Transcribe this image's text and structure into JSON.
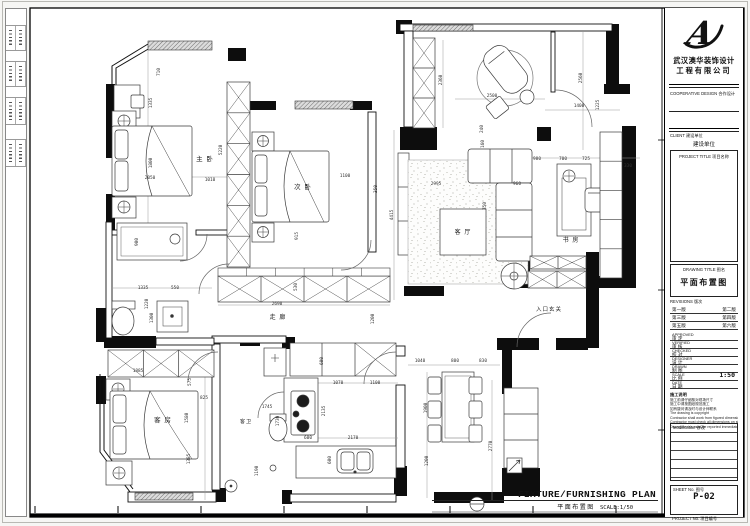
{
  "titleblock": {
    "logo_letter": "A",
    "company_line1": "武汉澳华装饰设计",
    "company_line2": "工程有限公司",
    "cooperative_label": "COOPERATIVE DESIGN   合作设计",
    "client_label": "CLIENT   建设单位",
    "client_value": "建设单位",
    "project_title_label": "PROJECT TITLE   项目名称",
    "drawing_title_label": "DRAWING TITLE   图名",
    "drawing_title_value": "平面布置图",
    "revisions_label": "REVISIONS   版次",
    "revision_rows": [
      [
        "第一版",
        "第二版"
      ],
      [
        "第三版",
        "第四版"
      ],
      [
        "第五版",
        "第六版"
      ]
    ],
    "sign_rows": [
      {
        "en": "APPROVED",
        "zh": "审 定",
        "value": ""
      },
      {
        "en": "VERIFIED",
        "zh": "审 核",
        "value": ""
      },
      {
        "en": "CHECKED",
        "zh": "校 对",
        "value": ""
      },
      {
        "en": "DESIGNER",
        "zh": "设 计",
        "value": ""
      },
      {
        "en": "DRAWN",
        "zh": "制 图",
        "value": ""
      },
      {
        "en": "SCALE",
        "zh": "比 例",
        "value": "1:50"
      },
      {
        "en": "DATE",
        "zh": "日 期",
        "value": ""
      }
    ],
    "notes_title": "施工说明",
    "notes": [
      "施工前请仔细核对现场尺寸",
      "施工中请按图纸规范施工",
      "如有疑问请及时与设计师联系",
      "The drawing is copyright",
      "Contractor shall work from figured dimensions only",
      "Contractor must check all dimensions on site",
      "Discrepancies must be reported immediately to architect"
    ],
    "modification_label": "Modification   修改",
    "sheet_no_label": "SHEET No.   图号",
    "sheet_no_value": "P-02",
    "project_no_label": "PROJECT No.   项目编号"
  },
  "footer": {
    "title_en": "FIXTURE/FURNISHING PLAN",
    "title_zh": "平面布置图",
    "scale": "SCALE:1/50"
  },
  "plan": {
    "rooms": [
      {
        "label": "主 卧",
        "x": 205,
        "y": 161,
        "s": 6.5
      },
      {
        "label": "次 卧",
        "x": 303,
        "y": 189,
        "s": 6.5
      },
      {
        "label": "客 厅",
        "x": 463,
        "y": 234,
        "s": 6
      },
      {
        "label": "书 房",
        "x": 571,
        "y": 242,
        "s": 6
      },
      {
        "label": "走 廊",
        "x": 278,
        "y": 319,
        "s": 6
      },
      {
        "label": "入口玄关",
        "x": 549,
        "y": 311,
        "s": 5.5
      },
      {
        "label": "客 房",
        "x": 163,
        "y": 422,
        "s": 6.5
      },
      {
        "label": "客卫",
        "x": 246,
        "y": 423,
        "s": 5
      }
    ],
    "dims": [
      {
        "t": "710",
        "x": 160,
        "y": 72,
        "v": 1
      },
      {
        "t": "1335",
        "x": 152,
        "y": 103,
        "v": 1
      },
      {
        "t": "1800",
        "x": 152,
        "y": 163,
        "v": 1
      },
      {
        "t": "2050",
        "x": 150,
        "y": 179,
        "v": 0
      },
      {
        "t": "1010",
        "x": 210,
        "y": 181,
        "v": 0
      },
      {
        "t": "5220",
        "x": 222,
        "y": 150,
        "v": 1
      },
      {
        "t": "915",
        "x": 298,
        "y": 236,
        "v": 1
      },
      {
        "t": "1100",
        "x": 345,
        "y": 177,
        "v": 0
      },
      {
        "t": "350",
        "x": 377,
        "y": 189,
        "v": 1
      },
      {
        "t": "4415",
        "x": 393,
        "y": 215,
        "v": 1
      },
      {
        "t": "2360",
        "x": 442,
        "y": 80,
        "v": 1
      },
      {
        "t": "2500",
        "x": 492,
        "y": 97,
        "v": 0
      },
      {
        "t": "2560",
        "x": 582,
        "y": 78,
        "v": 1
      },
      {
        "t": "1400",
        "x": 579,
        "y": 107,
        "v": 0
      },
      {
        "t": "1225",
        "x": 599,
        "y": 105,
        "v": 1
      },
      {
        "t": "240",
        "x": 483,
        "y": 129,
        "v": 1
      },
      {
        "t": "980",
        "x": 537,
        "y": 160,
        "v": 0
      },
      {
        "t": "700",
        "x": 563,
        "y": 160,
        "v": 0
      },
      {
        "t": "725",
        "x": 586,
        "y": 160,
        "v": 0
      },
      {
        "t": "330",
        "x": 628,
        "y": 167,
        "v": 0
      },
      {
        "t": "2995",
        "x": 436,
        "y": 185,
        "v": 0
      },
      {
        "t": "160",
        "x": 484,
        "y": 144,
        "v": 1
      },
      {
        "t": "350",
        "x": 486,
        "y": 206,
        "v": 1
      },
      {
        "t": "960",
        "x": 517,
        "y": 185,
        "v": 0
      },
      {
        "t": "2690",
        "x": 277,
        "y": 305,
        "v": 0
      },
      {
        "t": "530",
        "x": 297,
        "y": 287,
        "v": 1
      },
      {
        "t": "1200",
        "x": 374,
        "y": 319,
        "v": 1
      },
      {
        "t": "1885",
        "x": 138,
        "y": 372,
        "v": 0
      },
      {
        "t": "575",
        "x": 191,
        "y": 382,
        "v": 1
      },
      {
        "t": "825",
        "x": 204,
        "y": 399,
        "v": 0
      },
      {
        "t": "1580",
        "x": 188,
        "y": 418,
        "v": 1
      },
      {
        "t": "1385",
        "x": 190,
        "y": 459,
        "v": 1
      },
      {
        "t": "1190",
        "x": 258,
        "y": 471,
        "v": 1
      },
      {
        "t": "1745",
        "x": 267,
        "y": 408,
        "v": 0
      },
      {
        "t": "1730",
        "x": 279,
        "y": 421,
        "v": 1
      },
      {
        "t": "600",
        "x": 323,
        "y": 361,
        "v": 1
      },
      {
        "t": "1070",
        "x": 338,
        "y": 384,
        "v": 0
      },
      {
        "t": "1100",
        "x": 375,
        "y": 384,
        "v": 0
      },
      {
        "t": "2135",
        "x": 325,
        "y": 411,
        "v": 1
      },
      {
        "t": "600",
        "x": 308,
        "y": 439,
        "v": 0
      },
      {
        "t": "2170",
        "x": 353,
        "y": 439,
        "v": 0
      },
      {
        "t": "600",
        "x": 331,
        "y": 460,
        "v": 1
      },
      {
        "t": "1040",
        "x": 420,
        "y": 362,
        "v": 0
      },
      {
        "t": "800",
        "x": 455,
        "y": 362,
        "v": 0
      },
      {
        "t": "830",
        "x": 483,
        "y": 362,
        "v": 0
      },
      {
        "t": "1900",
        "x": 427,
        "y": 408,
        "v": 1
      },
      {
        "t": "1200",
        "x": 428,
        "y": 461,
        "v": 1
      },
      {
        "t": "2770",
        "x": 492,
        "y": 446,
        "v": 1
      },
      {
        "t": "900",
        "x": 138,
        "y": 242,
        "v": 1
      },
      {
        "t": "1335",
        "x": 143,
        "y": 289,
        "v": 0
      },
      {
        "t": "1220",
        "x": 148,
        "y": 304,
        "v": 1
      },
      {
        "t": "1300",
        "x": 153,
        "y": 318,
        "v": 1
      },
      {
        "t": "550",
        "x": 175,
        "y": 289,
        "v": 0
      }
    ]
  }
}
